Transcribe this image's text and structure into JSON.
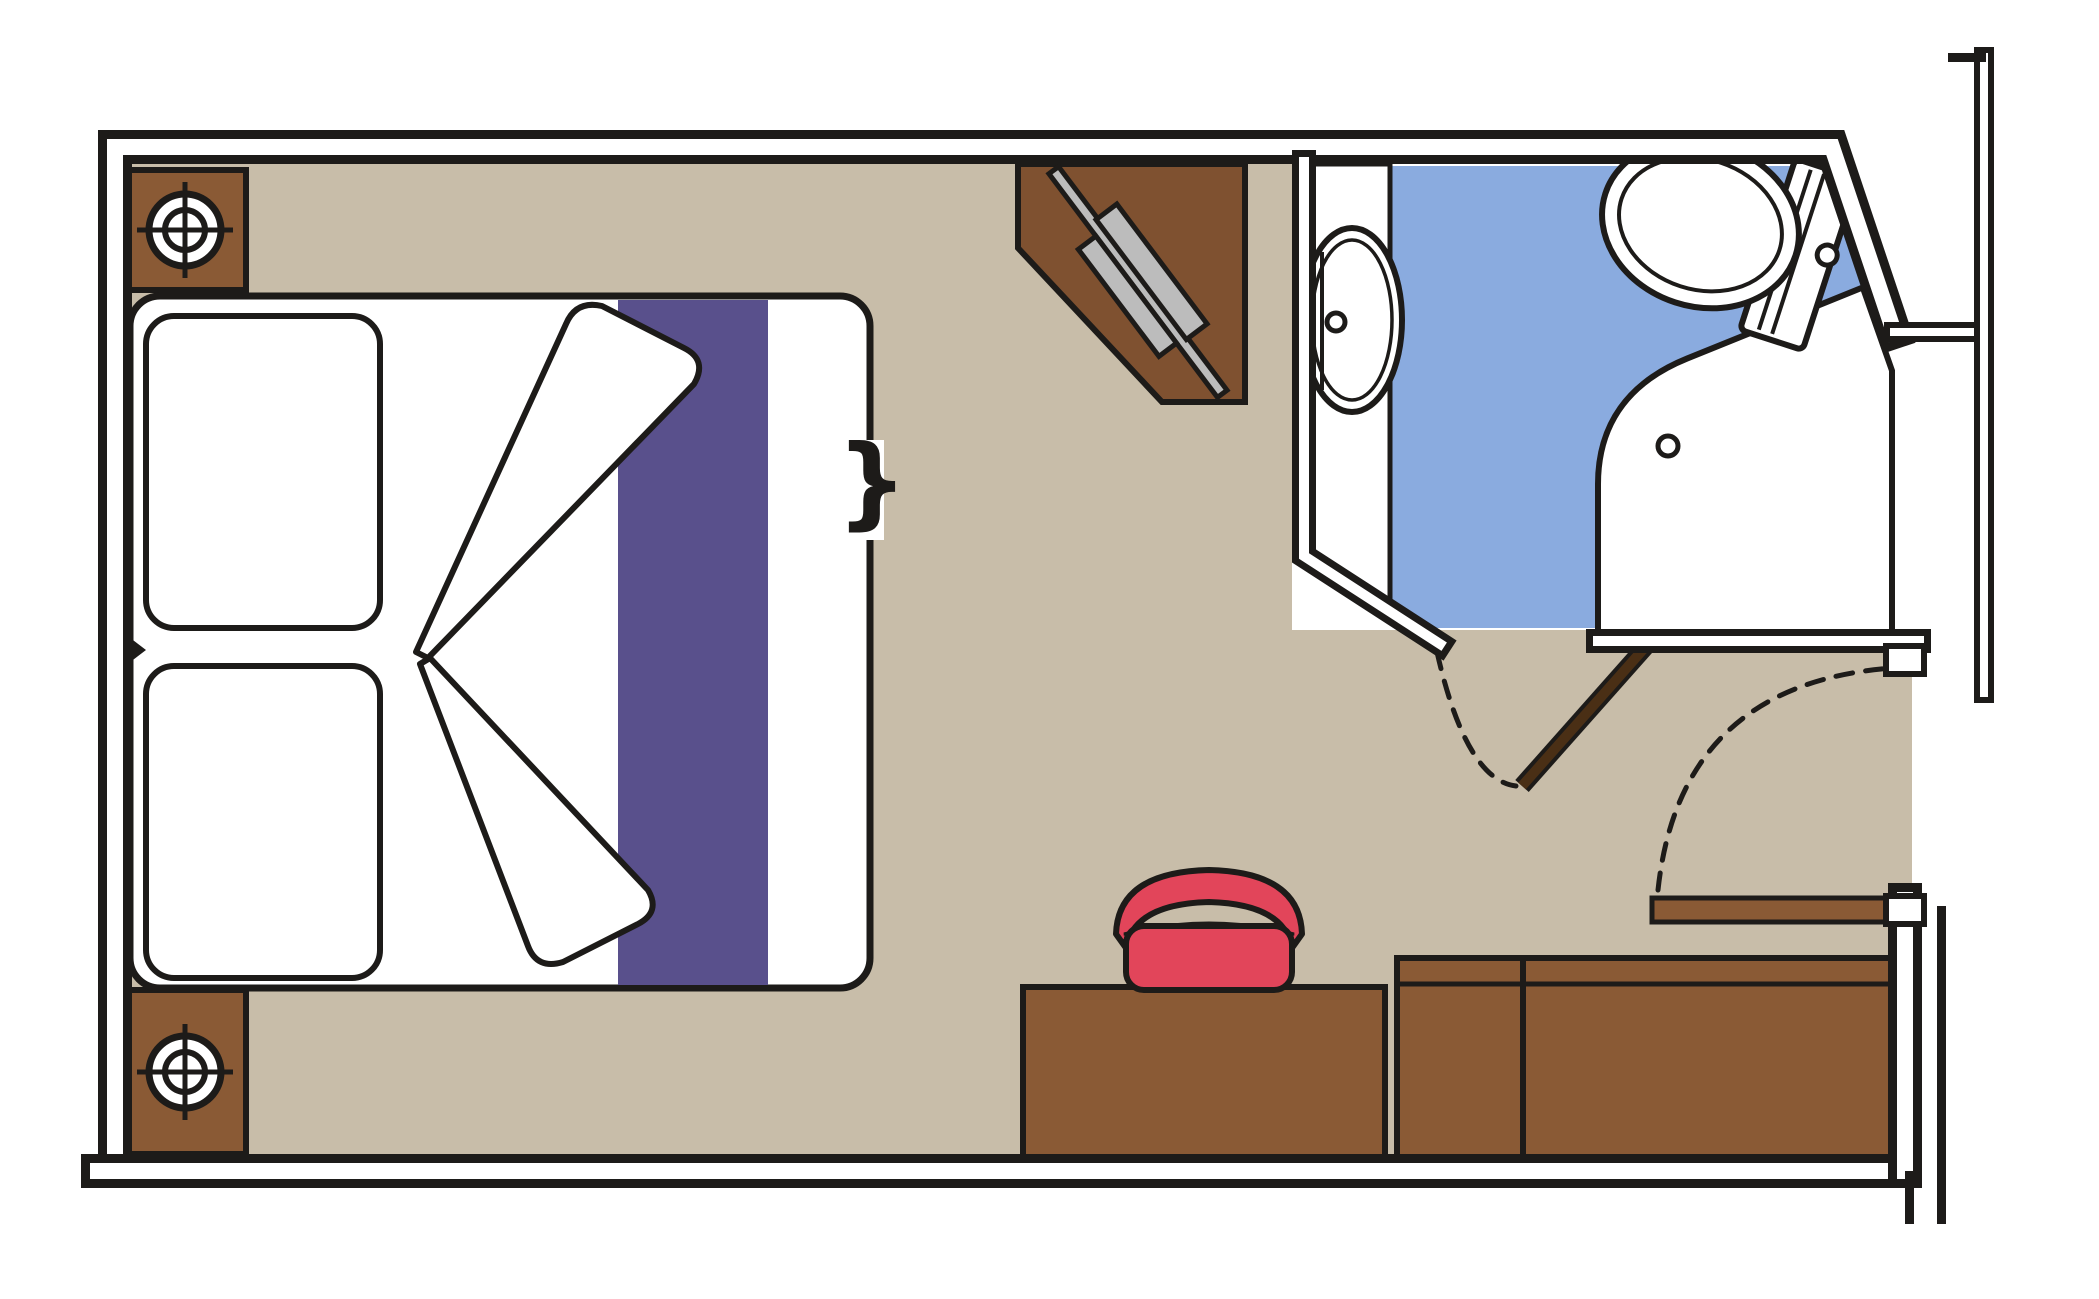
{
  "figure": {
    "kind": "floor-plan",
    "subject": "cabin-stateroom-top-view"
  },
  "colors": {
    "line": "#1d1b19",
    "floor": "#c8bda9",
    "furniture": "#8a5a35",
    "cabinet": "#7f5130",
    "door-leaf": "#4a2f15",
    "runner-purple": "#59508c",
    "stool-red": "#e2455a",
    "stool-seam": "#6a6a6a",
    "bath-blue": "#8aabdf",
    "tv-gray": "#bcbcbc",
    "wall-white": "#ffffff"
  },
  "elements": {
    "plan": {
      "label": "Cabin floor plan"
    },
    "walls": {
      "label": "Cabin walls"
    },
    "bed": {
      "label": "Double bed"
    },
    "pillow_top": {
      "label": "Pillow"
    },
    "pillow_bottom": {
      "label": "Pillow"
    },
    "runner": {
      "label": "Bed runner"
    },
    "duvet_folds": {
      "label": "Folded duvet corners"
    },
    "split_bracket": {
      "label": "Convertible bed split marker"
    },
    "nightstand_top": {
      "label": "Nightstand with reading lamp"
    },
    "nightstand_bottom": {
      "label": "Nightstand with reading lamp"
    },
    "lamp": {
      "label": "Reading lamp"
    },
    "tv_cabinet": {
      "label": "Corner TV cabinet"
    },
    "tv": {
      "label": "Television"
    },
    "bathroom": {
      "label": "Bathroom"
    },
    "sink_counter": {
      "label": "Washbasin counter"
    },
    "sink": {
      "label": "Washbasin"
    },
    "toilet": {
      "label": "Toilet"
    },
    "shower": {
      "label": "Shower enclosure"
    },
    "shower_drain": {
      "label": "Shower drain"
    },
    "bathroom_door": {
      "label": "Bathroom door"
    },
    "bathroom_door_swing": {
      "label": "Bathroom door swing"
    },
    "entry_door": {
      "label": "Entrance door"
    },
    "entry_door_swing": {
      "label": "Entrance door swing"
    },
    "desk": {
      "label": "Desk / vanity"
    },
    "stool": {
      "label": "Stool"
    },
    "wardrobe": {
      "label": "Wardrobe"
    },
    "hull_wall": {
      "label": "Outer corridor wall"
    }
  }
}
